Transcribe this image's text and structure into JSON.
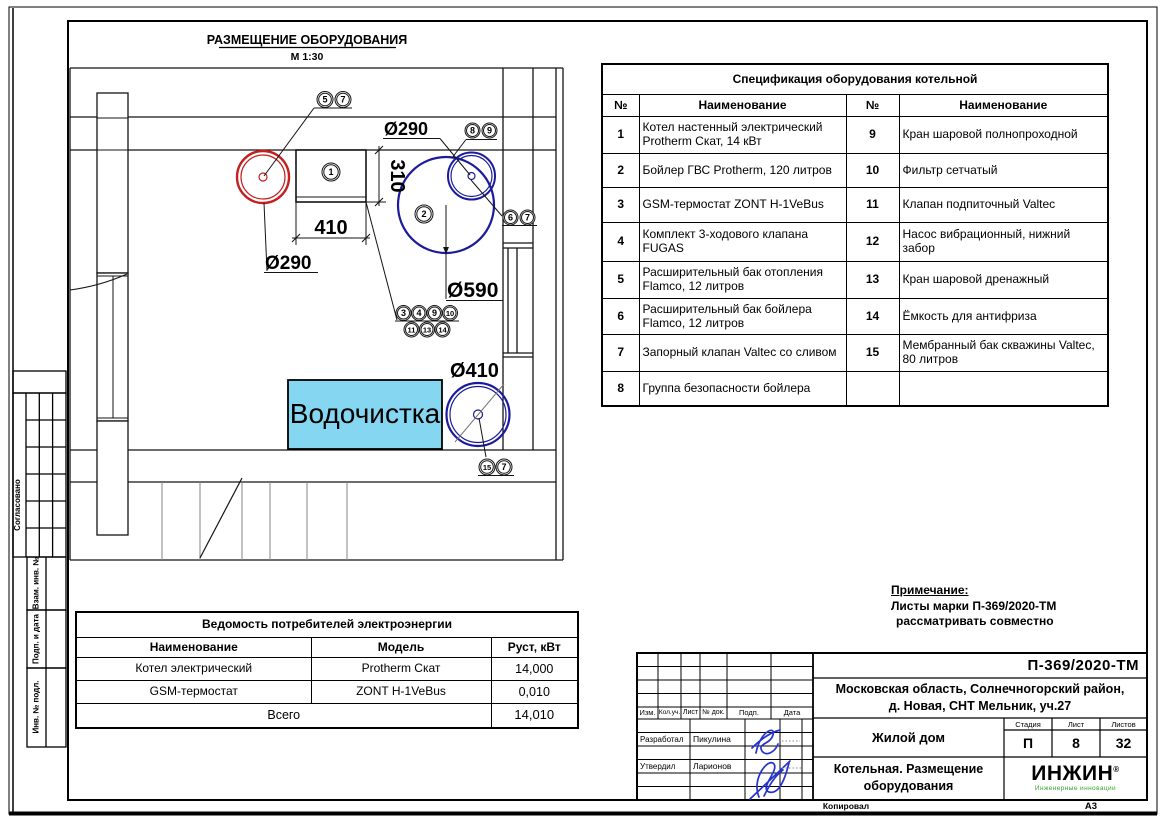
{
  "colors": {
    "red": "#c51f1f",
    "blue": "#1b1b9c",
    "water_fill": "#85d6f1",
    "logo_green": "#3aa62e",
    "signature_blue": "#2433cc"
  },
  "plan": {
    "title": "РАЗМЕЩЕНИЕ ОБОРУДОВАНИЯ",
    "scale": "М 1:30",
    "water_label": "Водочистка",
    "labels": {
      "d290_top": "Ø290",
      "d290_left": "Ø290",
      "d590": "Ø590",
      "d410": "Ø410",
      "width": "410",
      "height": "310"
    },
    "balloons": [
      "5",
      "7",
      "1",
      "2",
      "8",
      "9",
      "6",
      "7",
      "3",
      "4",
      "9",
      "10",
      "11",
      "13",
      "14",
      "15",
      "7"
    ]
  },
  "side_strip": {
    "items": [
      "Согласовано",
      "Взам. инв. №",
      "Подп. и дата",
      "Инв. № подл."
    ]
  },
  "spec_table": {
    "title": "Спецификация оборудования котельной",
    "headers": [
      "№",
      "Наименование",
      "№",
      "Наименование"
    ],
    "rows": [
      [
        "1",
        "Котел настенный электрический Protherm Скат, 14 кВт",
        "9",
        "Кран шаровой полнопроходной"
      ],
      [
        "2",
        "Бойлер ГВС Protherm, 120 литров",
        "10",
        "Фильтр сетчатый"
      ],
      [
        "3",
        "GSM-термостат ZONT H-1VeBus",
        "11",
        "Клапан подпиточный Valtec"
      ],
      [
        "4",
        "Комплект 3-ходового клапана FUGAS",
        "12",
        "Насос вибрационный, нижний забор"
      ],
      [
        "5",
        "Расширительный бак отопления Flamco, 12 литров",
        "13",
        "Кран шаровой дренажный"
      ],
      [
        "6",
        "Расширительный бак бойлера Flamco, 12 литров",
        "14",
        "Ёмкость для антифриза"
      ],
      [
        "7",
        "Запорный клапан Valtec со сливом",
        "15",
        "Мембранный бак скважины Valtec, 80 литров"
      ],
      [
        "8",
        "Группа безопасности бойлера",
        "",
        ""
      ]
    ]
  },
  "power_table": {
    "title": "Ведомость потребителей электроэнергии",
    "headers": [
      "Наименование",
      "Модель",
      "Руст, кВт"
    ],
    "rows": [
      [
        "Котел электрический",
        "Protherm Скат",
        "14,000"
      ],
      [
        "GSM-термостат",
        "ZONT H-1VeBus",
        "0,010"
      ]
    ],
    "total_label": "Всего",
    "total_value": "14,010"
  },
  "note": {
    "title": "Примечание:",
    "line1": "Листы марки П-369/2020-ТМ",
    "line2": "рассматривать совместно"
  },
  "title_block": {
    "doc_number": "П-369/2020-ТМ",
    "address_line1": "Московская область, Солнечногорский район,",
    "address_line2": "д. Новая, СНТ Мельник, уч.27",
    "object_name": "Жилой дом",
    "sheet_title_line1": "Котельная. Размещение",
    "sheet_title_line2": "оборудования",
    "stage_label": "Стадия",
    "sheet_label": "Лист",
    "sheets_label": "Листов",
    "stage": "П",
    "sheet_number": "8",
    "sheets_total": "32",
    "rev_headers": [
      "Изм.",
      "Кол.уч.",
      "Лист",
      "№ док.",
      "Подп.",
      "Дата"
    ],
    "developed_label": "Разработал",
    "developed_name": "Пикулина",
    "approved_label": "Утвердил",
    "approved_name": "Ларионов",
    "logo_text": "ИНЖИН",
    "logo_reg": "®",
    "logo_subtitle": "Инженерные инновации",
    "copied_label": "Копировал",
    "format_label": "А3"
  }
}
